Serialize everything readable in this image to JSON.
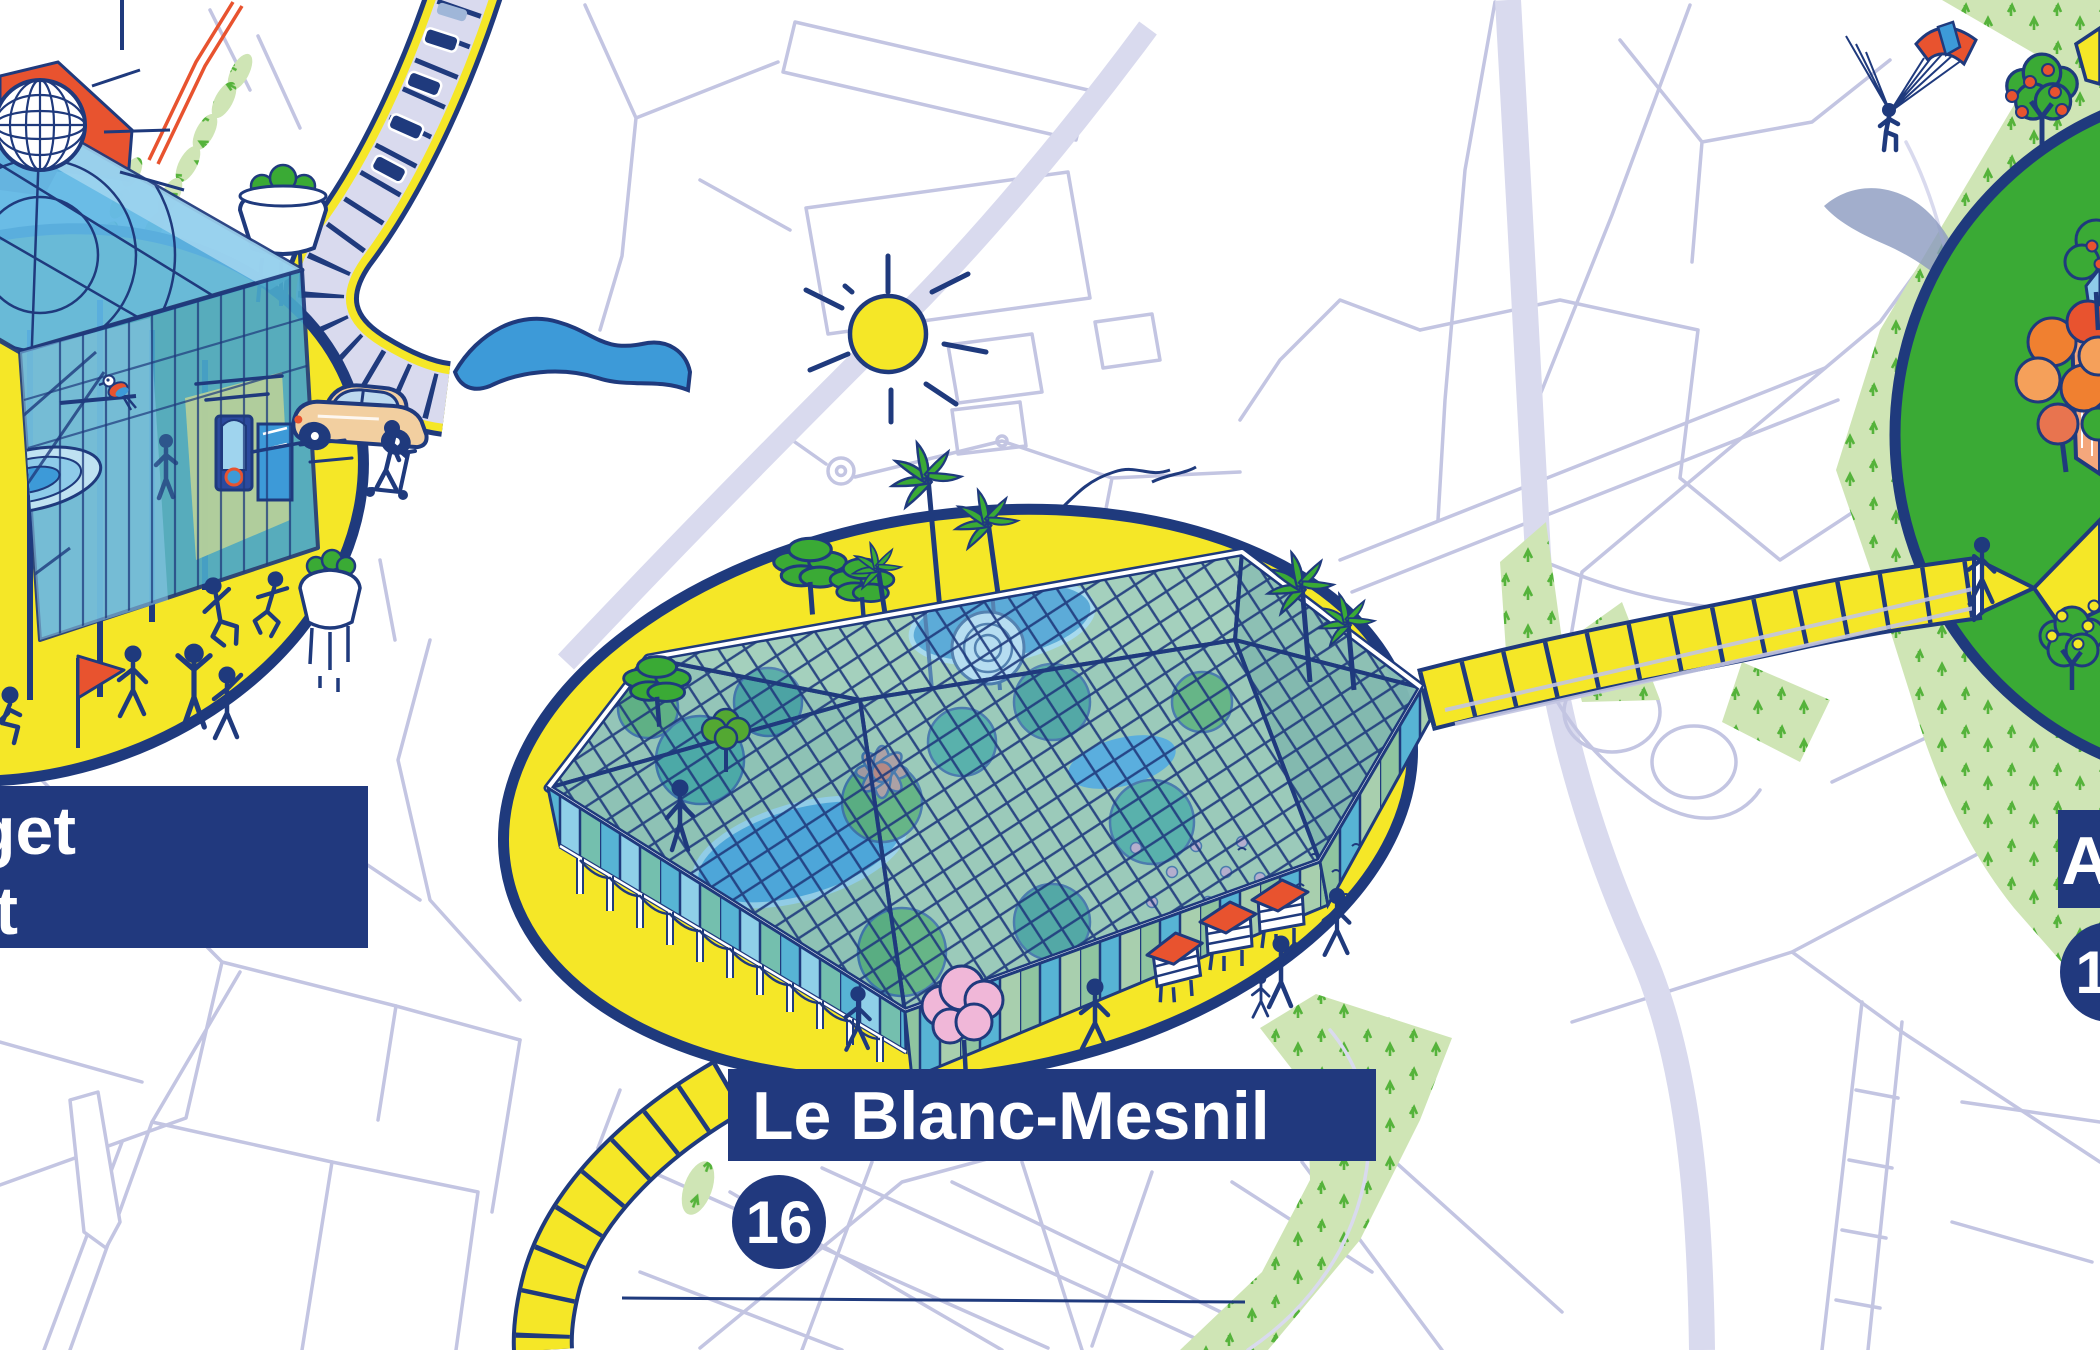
{
  "scene": {
    "description": "Illustrated isometric transit map: glass pavilion stations on yellow platforms linked by yellow line segments over a pale street map",
    "background": "#ffffff"
  },
  "stations": {
    "left": {
      "label_line1": "get",
      "label_line2": "t"
    },
    "center": {
      "label": "Le Blanc-Mesnil",
      "badge": "16"
    },
    "right": {
      "label": "A",
      "badge": "1"
    }
  },
  "colors": {
    "outline_navy": "#1f3a7d",
    "label_bg": "#21397e",
    "label_text": "#ffffff",
    "platform_yellow": "#f5e727",
    "road_thin": "#c3c5e2",
    "road_wide": "#d9daee",
    "park_green": "#cfe5b5",
    "tuft_green": "#55b33b",
    "grass_bright": "#3aaa35",
    "glass_blue": "#5fb7e5",
    "glass_teal": "#4aa8c9",
    "water_blue": "#3d9ad8",
    "accent_red": "#e8532f",
    "wing_shadow": "#8b9abf",
    "tree_pink": "#f0b7d8",
    "salmon": "#f4a77c",
    "car_beige": "#f2cfa0",
    "interior_green": "#b5cf9a",
    "autumn_orange": "#f08030"
  },
  "illustration_elements": [
    "sun-icon",
    "bird-icon",
    "paraglider-icon",
    "geodesic-globe-icon",
    "glass-cube-pavilion",
    "greenhouse-pavilion",
    "flag-icon",
    "beehive-icon",
    "palm-tree-icon",
    "pine-tree-icon",
    "pink-tree-icon",
    "apple-tree-icon",
    "orange-tree-icon",
    "parrot-icon",
    "flying-car-icon",
    "scooter-icon",
    "train-icon",
    "stick-figures",
    "planter-icon",
    "water-tower-icon",
    "river",
    "railway",
    "metro-line-segment",
    "motorway",
    "park",
    "promenade",
    "beehives"
  ]
}
